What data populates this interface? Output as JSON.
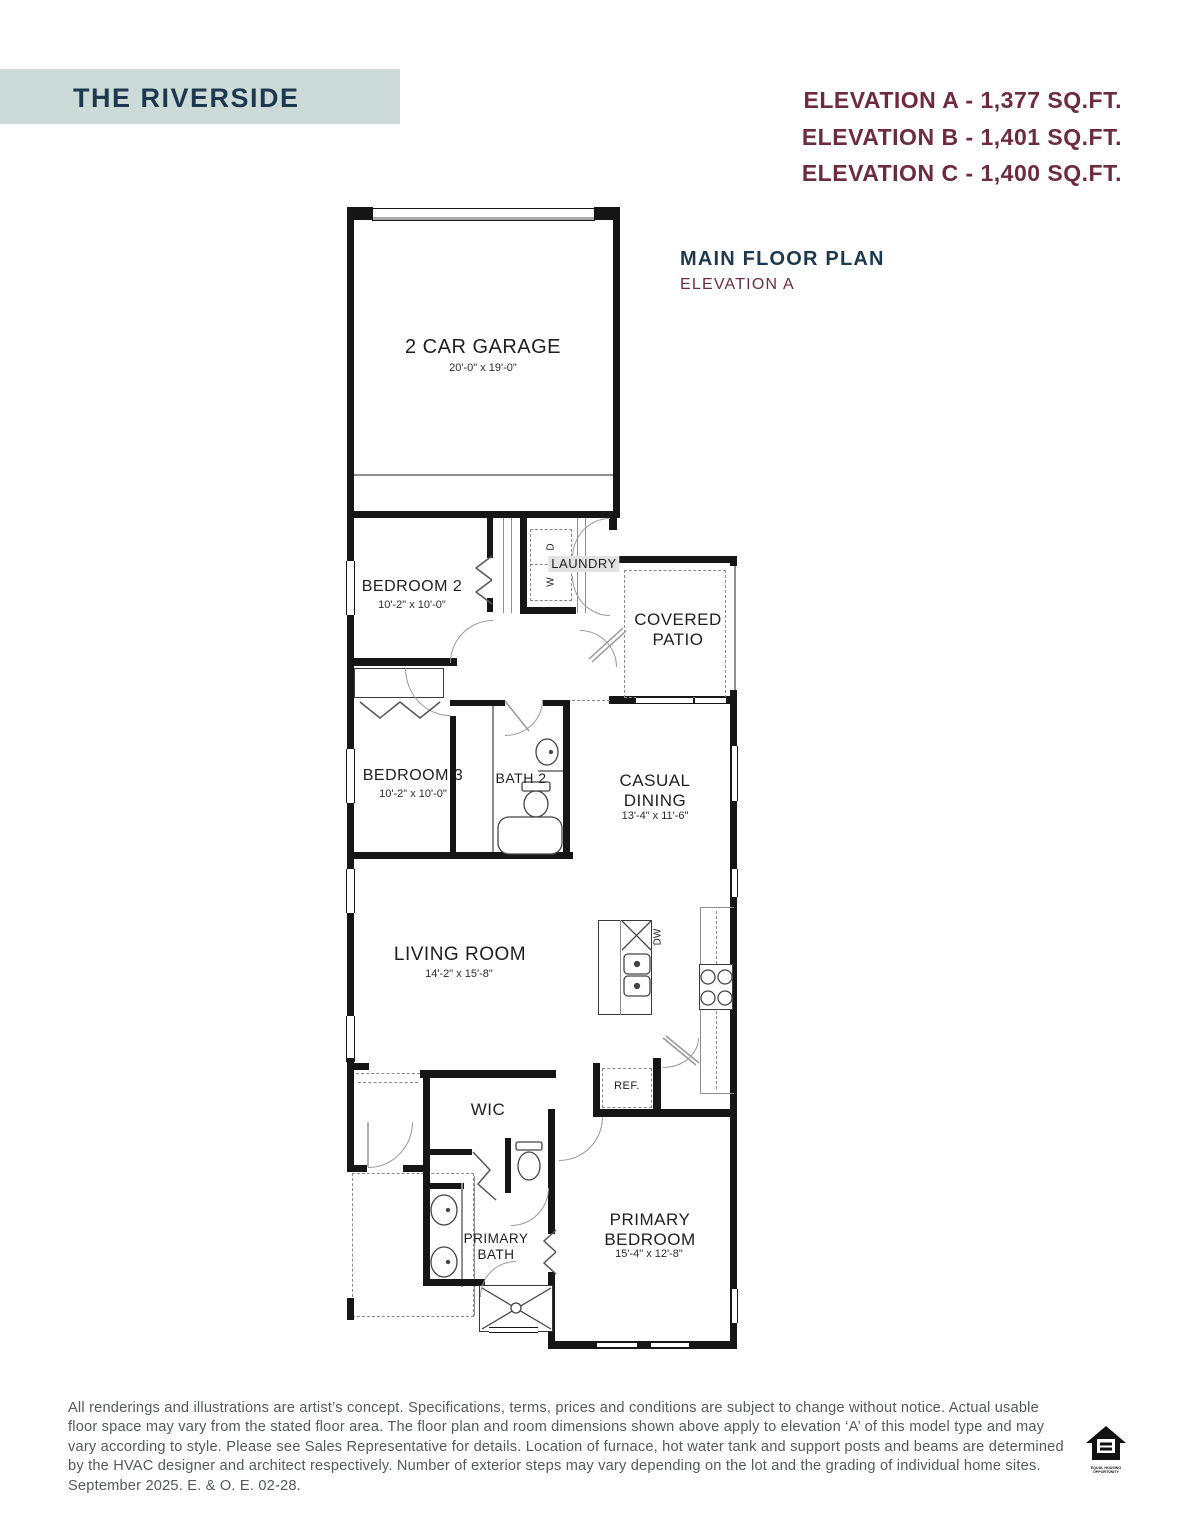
{
  "header": {
    "title": "THE RIVERSIDE",
    "elevations": [
      "ELEVATION A - 1,377 SQ.FT.",
      "ELEVATION B - 1,401 SQ.FT.",
      "ELEVATION C - 1,400 SQ.FT."
    ]
  },
  "plan_label": {
    "title": "MAIN FLOOR PLAN",
    "subtitle": "ELEVATION A"
  },
  "rooms": {
    "garage": {
      "name": "2 CAR GARAGE",
      "dims": "20'-0\" x 19'-0\""
    },
    "bedroom2": {
      "name": "BEDROOM 2",
      "dims": "10'-2\" x 10'-0\""
    },
    "laundry": {
      "name": "LAUNDRY",
      "washer": "W",
      "dryer": "D"
    },
    "covered_patio": {
      "name": "COVERED PATIO"
    },
    "bedroom3": {
      "name": "BEDROOM 3",
      "dims": "10'-2\" x 10'-0\""
    },
    "bath2": {
      "name": "BATH 2"
    },
    "casual_dining": {
      "name": "CASUAL DINING",
      "dims": "13'-4\" x 11'-6\""
    },
    "living_room": {
      "name": "LIVING ROOM",
      "dims": "14'-2\" x 15'-8\""
    },
    "kitchen": {
      "dishwasher": "DW",
      "fridge": "REF."
    },
    "wic": {
      "name": "WIC"
    },
    "primary_bath": {
      "name": "PRIMARY BATH"
    },
    "primary_bedroom": {
      "name": "PRIMARY BEDROOM",
      "dims": "15'-4\" x 12'-8\""
    }
  },
  "footer": {
    "disclaimer": "All renderings and illustrations are artist’s concept. Specifications, terms, prices and conditions are subject to change without notice. Actual usable floor space may vary from the stated floor area. The floor plan and room dimensions shown above apply to elevation ‘A’ of this model type and may vary according to style. Please see Sales Representative for details. Location of furnace, hot water tank and support posts and beams are determined by the HVAC designer and architect respectively. Number of exterior steps may vary depending on the lot and the grading of individual home sites. September 2025. E. & O. E. 02-28.",
    "equal_housing_line1": "EQUAL HOUSING",
    "equal_housing_line2": "OPPORTUNITY"
  },
  "colors": {
    "banner": "#ccdbd7",
    "navy": "#1d3950",
    "maroon": "#6f2b3e",
    "plan_line": "#161616",
    "disclaimer_gray": "#55585b"
  }
}
